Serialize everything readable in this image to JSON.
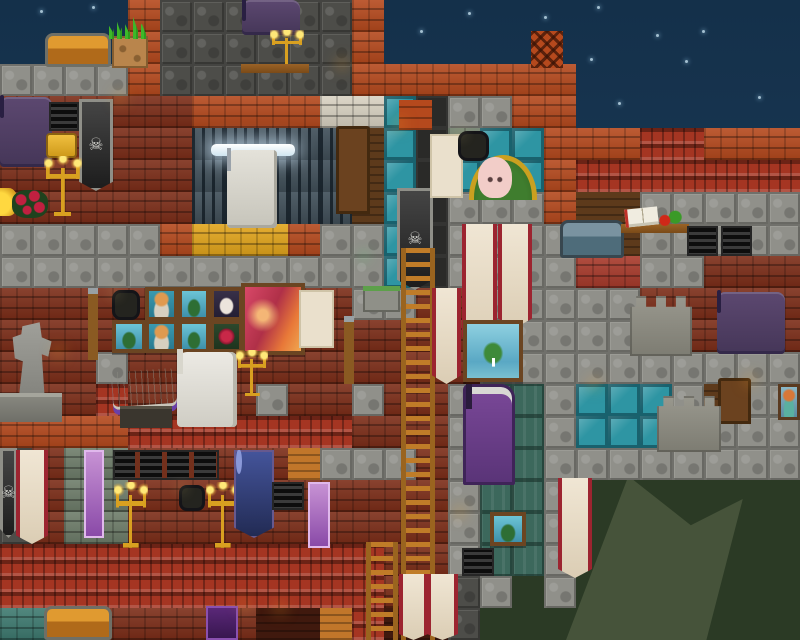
{
  "screen": {
    "width": 800,
    "height": 640
  },
  "palette": {
    "skyTop": "#14304a",
    "skyBottom": "#204260",
    "hills": "#2b3a25",
    "hillLight": "#46533a",
    "flame": "#ffb428",
    "gold": "#d8a020",
    "bannerRed": "#9c2430",
    "cream": "#f0e6d4",
    "teal": "#45e0d8",
    "purpleTv": "#5c4870"
  },
  "scene": {
    "tile_size": 32,
    "grid": [
      25,
      20
    ],
    "legend": {
      "B": {
        "name": "tile-brick-orange",
        "color": "#b5491d"
      },
      "b": {
        "name": "tile-brick-dark-red",
        "color": "#7c2d18"
      },
      "S": {
        "name": "tile-stone-block",
        "color": "#90908a"
      },
      "s": {
        "name": "tile-cobble-dark",
        "color": "#4d4d49"
      },
      "T": {
        "name": "tile-glass-teal",
        "color": "#2e95a3"
      },
      "R": {
        "name": "tile-roof-shingles",
        "color": "#a53522"
      },
      "G": {
        "name": "tile-gold-block",
        "color": "#e2a51c"
      },
      "W": {
        "name": "tile-brick-white",
        "color": "#d9d2c2"
      },
      "K": {
        "name": "tile-stone-green",
        "color": "#6e7d6a"
      },
      "w": {
        "name": "tile-wood-panel",
        "color": "#5d3a1b"
      },
      "O": {
        "name": "tile-wood-beam",
        "color": "#c1762a"
      },
      "D": {
        "name": "tile-dark-shaft",
        "color": "#2a2a28"
      },
      "J": {
        "name": "tile-window-bars",
        "color": "#46555f"
      },
      "t": {
        "name": "tile-brick-teal",
        "color": "#3e7a70"
      },
      "m": {
        "name": "tile-maroon-dark",
        "color": "#40190e"
      },
      "q": {
        "name": "tile-block-red",
        "color": "#a83a2b"
      },
      "P": {
        "name": "tile-panel-teal",
        "color": "#3c685c"
      }
    },
    "rows": [
      "....BssssssB.............",
      "....BssssssB.............",
      "SSSSBssssssBBBBBBB.......",
      "bbbbbbBBBBWWTDSSBB.......",
      "bbbbbbJJJJJwTDKTTBBBRRBBB",
      "bbbbbbJJJJJwTDTTTBRRRRRRR",
      "bbbbbbJJJJJwTDSSSBwwSSSSS",
      "SSSSSBGGGBSSTDSSSSwwSSSSS",
      "SSSSSSSSSSSSTDSSSSqqSSbbb",
      "bbbbbbbbbbbSSbbSSSSSbbbbb",
      "bbbbbbbbbbbbbbbSSSSSbbbbb",
      "bbbSbbbbbbbbbbbSSSSSSSSSS",
      "bbbRbbbbSbbSbbSPPSTTTSwSS",
      "BBBBRRRRRRRbbbSPPSTTTSSSS",
      "sbKKbbbbbOSSSbSPPSSSSSSSS",
      "sbKKbbbbbbbbbbSPPS.......",
      "sbKKbbbbbbbbbbSPPS.......",
      "RRRRRRRRRRRRbbSPPS.......",
      "RRRRRRRRRRRRbssS.S.......",
      "ttbbbbbbmmORmms.........."
    ],
    "backdrop": [
      {
        "t": "hill",
        "n": "hills-dark-west",
        "x": 455,
        "y": 540,
        "w": 345,
        "h": 100
      },
      {
        "t": "hill",
        "n": "hills-dark-east",
        "x": 533,
        "y": 476,
        "w": 267,
        "h": 164
      },
      {
        "t": "hill2",
        "n": "hillside-ridge",
        "x": 540,
        "y": 476,
        "w": 260,
        "h": 164
      }
    ],
    "stars": [
      [
        40,
        10
      ],
      [
        92,
        6
      ],
      [
        420,
        30
      ],
      [
        468,
        12
      ],
      [
        544,
        16
      ],
      [
        597,
        6
      ],
      [
        656,
        34
      ],
      [
        590,
        58
      ],
      [
        618,
        102
      ],
      [
        702,
        30
      ],
      [
        758,
        96
      ],
      [
        685,
        60
      ]
    ],
    "entities": [
      {
        "t": "block-orange",
        "n": "shaft-cap-block",
        "x": 399,
        "y": 100,
        "w": 33,
        "h": 30,
        "i": false
      },
      {
        "t": "lattice",
        "n": "chimney-lattice",
        "x": 531,
        "y": 31,
        "w": 32,
        "h": 37,
        "i": false
      },
      {
        "t": "door",
        "n": "wooden-door-upper",
        "x": 336,
        "y": 126,
        "w": 34,
        "h": 88,
        "i": true
      },
      {
        "t": "moss",
        "n": "mossy-ledge",
        "x": 363,
        "y": 286,
        "w": 37,
        "h": 26,
        "i": false
      },
      {
        "t": "tv",
        "n": "wall-tv-left",
        "x": 0,
        "y": 97,
        "w": 52,
        "h": 70,
        "i": true
      },
      {
        "t": "vent",
        "n": "air-vent-1",
        "x": 49,
        "y": 102,
        "w": 30,
        "h": 29,
        "i": false
      },
      {
        "t": "sign",
        "n": "gold-sign",
        "x": 46,
        "y": 133,
        "w": 31,
        "h": 25,
        "i": false
      },
      {
        "t": "banner-skull",
        "n": "skull-banner-left",
        "x": 79,
        "y": 99,
        "w": 34,
        "h": 92,
        "i": false
      },
      {
        "t": "torch",
        "n": "torch-upper-left",
        "x": 120,
        "y": 98,
        "w": 24,
        "h": 38,
        "i": false
      },
      {
        "t": "candelabra",
        "n": "wall-candelabra-left",
        "x": 44,
        "y": 156,
        "w": 38,
        "h": 60,
        "i": false
      },
      {
        "t": "goldpile",
        "n": "gold-treasure",
        "x": 0,
        "y": 188,
        "w": 18,
        "h": 28,
        "i": false
      },
      {
        "t": "roses",
        "n": "rose-bush",
        "x": 12,
        "y": 190,
        "w": 36,
        "h": 28,
        "i": false
      },
      {
        "t": "tv",
        "n": "wall-tv-dining",
        "x": 242,
        "y": 0,
        "w": 58,
        "h": 35,
        "i": true
      },
      {
        "t": "chair",
        "n": "dining-chair-left",
        "x": 203,
        "y": 46,
        "w": 30,
        "h": 52,
        "i": false
      },
      {
        "t": "chair",
        "n": "dining-chair-right",
        "x": 305,
        "y": 46,
        "w": 30,
        "h": 52,
        "i": false
      },
      {
        "t": "candelabra",
        "n": "table-candelabra",
        "x": 270,
        "y": 30,
        "w": 34,
        "h": 38,
        "i": false
      },
      {
        "t": "table",
        "n": "dining-table",
        "x": 241,
        "y": 64,
        "w": 68,
        "h": 34,
        "i": false
      },
      {
        "t": "torch",
        "n": "torch-dining",
        "x": 342,
        "y": 64,
        "w": 24,
        "h": 36,
        "i": false
      },
      {
        "t": "chest-wood",
        "n": "wooden-chest-top",
        "x": 45,
        "y": 33,
        "w": 66,
        "h": 34,
        "i": true
      },
      {
        "t": "dirt",
        "n": "dirt-block",
        "x": 112,
        "y": 36,
        "w": 36,
        "h": 32,
        "i": false
      },
      {
        "t": "grass",
        "n": "grass-tuft",
        "x": 109,
        "y": 17,
        "w": 40,
        "h": 22,
        "i": false
      },
      {
        "t": "fluoro",
        "n": "fluorescent-lamp",
        "x": 211,
        "y": 144,
        "w": 84,
        "h": 12,
        "i": false
      },
      {
        "t": "machine",
        "n": "crafting-station",
        "x": 227,
        "y": 150,
        "w": 50,
        "h": 78,
        "i": true
      },
      {
        "t": "stool",
        "n": "workshop-stool",
        "x": 275,
        "y": 194,
        "w": 28,
        "h": 32,
        "i": false
      },
      {
        "t": "char-engineer",
        "n": "npc-engineer",
        "x": 184,
        "y": 164,
        "w": 44,
        "h": 60,
        "i": true
      },
      {
        "t": "lantern",
        "n": "caged-lantern-1",
        "x": 112,
        "y": 290,
        "w": 28,
        "h": 30,
        "i": false
      },
      {
        "t": "p-portrait",
        "n": "painting-portrait-1",
        "x": 145,
        "y": 287,
        "w": 33,
        "h": 34,
        "i": false
      },
      {
        "t": "p-island",
        "n": "painting-island-1",
        "x": 178,
        "y": 287,
        "w": 32,
        "h": 34,
        "i": false
      },
      {
        "t": "p-bunny",
        "n": "painting-bunny",
        "x": 210,
        "y": 287,
        "w": 33,
        "h": 34,
        "i": false
      },
      {
        "t": "p-island",
        "n": "painting-island-2",
        "x": 112,
        "y": 320,
        "w": 34,
        "h": 33,
        "i": false
      },
      {
        "t": "p-portrait",
        "n": "painting-portrait-2",
        "x": 145,
        "y": 320,
        "w": 33,
        "h": 33,
        "i": false
      },
      {
        "t": "p-island",
        "n": "painting-island-3",
        "x": 178,
        "y": 320,
        "w": 32,
        "h": 33,
        "i": false
      },
      {
        "t": "p-rose",
        "n": "painting-rose",
        "x": 210,
        "y": 320,
        "w": 33,
        "h": 33,
        "i": false
      },
      {
        "t": "p-sunset",
        "n": "painting-sunset-large",
        "x": 241,
        "y": 283,
        "w": 64,
        "h": 72,
        "i": false
      },
      {
        "t": "poster",
        "n": "cat-poster-1",
        "x": 299,
        "y": 290,
        "w": 35,
        "h": 58,
        "i": false
      },
      {
        "t": "pole",
        "n": "hook-pole-1",
        "x": 88,
        "y": 288,
        "w": 10,
        "h": 72,
        "i": false
      },
      {
        "t": "pole",
        "n": "hook-pole-2",
        "x": 344,
        "y": 316,
        "w": 10,
        "h": 68,
        "i": false
      },
      {
        "t": "statue",
        "n": "stone-statue",
        "x": 4,
        "y": 315,
        "w": 54,
        "h": 80,
        "i": false
      },
      {
        "t": "pedestal",
        "n": "statue-pedestal",
        "x": 0,
        "y": 393,
        "w": 62,
        "h": 29,
        "i": false
      },
      {
        "t": "torch",
        "n": "torch-statue",
        "x": 58,
        "y": 352,
        "w": 22,
        "h": 34,
        "i": false
      },
      {
        "t": "printer",
        "n": "book-machine",
        "x": 112,
        "y": 370,
        "w": 64,
        "h": 38,
        "i": true
      },
      {
        "t": "stand",
        "n": "machine-stand",
        "x": 120,
        "y": 406,
        "w": 52,
        "h": 22,
        "i": false
      },
      {
        "t": "console",
        "n": "navigation-console",
        "x": 177,
        "y": 352,
        "w": 60,
        "h": 75,
        "i": true
      },
      {
        "t": "candelabra",
        "n": "wall-candelabra-mid",
        "x": 236,
        "y": 350,
        "w": 32,
        "h": 46,
        "i": false
      },
      {
        "t": "mushroom",
        "n": "glow-mushroom",
        "x": 364,
        "y": 256,
        "w": 32,
        "h": 36,
        "i": false
      },
      {
        "t": "banner-skull",
        "n": "skull-banner-shaft",
        "x": 397,
        "y": 188,
        "w": 36,
        "h": 102,
        "i": false
      },
      {
        "t": "torch",
        "n": "torch-shaft",
        "x": 399,
        "y": 124,
        "w": 24,
        "h": 38,
        "i": false
      },
      {
        "t": "poster",
        "n": "cat-poster-2",
        "x": 430,
        "y": 134,
        "w": 33,
        "h": 64,
        "i": false
      },
      {
        "t": "lantern",
        "n": "caged-lantern-2",
        "x": 458,
        "y": 131,
        "w": 31,
        "h": 30,
        "i": false
      },
      {
        "t": "pet-house",
        "n": "pet-house",
        "x": 469,
        "y": 155,
        "w": 68,
        "h": 45,
        "i": false
      },
      {
        "t": "bunny",
        "n": "pet-bunny",
        "x": 478,
        "y": 157,
        "w": 34,
        "h": 41,
        "i": true
      },
      {
        "t": "ladder",
        "n": "ladder-main",
        "x": 401,
        "y": 248,
        "w": 34,
        "h": 392,
        "i": true
      },
      {
        "t": "char-astronaut",
        "n": "player-astronaut",
        "x": 403,
        "y": 326,
        "w": 34,
        "h": 64,
        "i": true
      },
      {
        "t": "banner-red",
        "n": "rune-banner-1",
        "x": 432,
        "y": 288,
        "w": 29,
        "h": 96,
        "i": false
      },
      {
        "t": "banner-red",
        "n": "rune-banner-2",
        "x": 462,
        "y": 224,
        "w": 35,
        "h": 124,
        "i": false
      },
      {
        "t": "banner-red",
        "n": "rune-banner-3",
        "x": 498,
        "y": 224,
        "w": 34,
        "h": 104,
        "i": false
      },
      {
        "t": "p-floating",
        "n": "painting-floating-island",
        "x": 463,
        "y": 320,
        "w": 60,
        "h": 62,
        "i": false
      },
      {
        "t": "arcade",
        "n": "arcade-cabinet",
        "x": 463,
        "y": 384,
        "w": 52,
        "h": 101,
        "i": true
      },
      {
        "t": "chest-fancy",
        "n": "fancy-chest",
        "x": 560,
        "y": 220,
        "w": 64,
        "h": 38,
        "i": true
      },
      {
        "t": "table",
        "n": "study-table",
        "x": 621,
        "y": 224,
        "w": 68,
        "h": 32,
        "i": false
      },
      {
        "t": "book",
        "n": "open-book",
        "x": 625,
        "y": 208,
        "w": 33,
        "h": 18,
        "i": false
      },
      {
        "t": "fruit",
        "n": "fruit-and-plant",
        "x": 657,
        "y": 210,
        "w": 26,
        "h": 16,
        "i": false
      },
      {
        "t": "vent",
        "n": "air-vent-2",
        "x": 687,
        "y": 226,
        "w": 31,
        "h": 30,
        "i": false
      },
      {
        "t": "vent",
        "n": "air-vent-3",
        "x": 721,
        "y": 226,
        "w": 31,
        "h": 30,
        "i": false
      },
      {
        "t": "tv",
        "n": "wall-tv-big",
        "x": 717,
        "y": 292,
        "w": 68,
        "h": 62,
        "i": true
      },
      {
        "t": "tower",
        "n": "stone-tower-upper",
        "x": 630,
        "y": 296,
        "w": 62,
        "h": 60,
        "i": false
      },
      {
        "t": "torch",
        "n": "torch-glass-wall",
        "x": 594,
        "y": 384,
        "w": 24,
        "h": 38,
        "i": false
      },
      {
        "t": "door",
        "n": "wooden-door-right",
        "x": 718,
        "y": 378,
        "w": 33,
        "h": 46,
        "i": true
      },
      {
        "t": "tower",
        "n": "stone-tower-lower",
        "x": 657,
        "y": 396,
        "w": 64,
        "h": 56,
        "i": false
      },
      {
        "t": "torch",
        "n": "torch-right-wall",
        "x": 750,
        "y": 380,
        "w": 26,
        "h": 40,
        "i": false
      },
      {
        "t": "portrait-mini",
        "n": "portrait-painting-right",
        "x": 778,
        "y": 384,
        "w": 22,
        "h": 36,
        "i": false
      },
      {
        "t": "sawhorse",
        "n": "sawhorse-table-right",
        "x": 592,
        "y": 416,
        "w": 62,
        "h": 34,
        "i": true
      },
      {
        "t": "banner-skull",
        "n": "skull-banner-bottom",
        "x": 0,
        "y": 448,
        "w": 17,
        "h": 90,
        "i": false
      },
      {
        "t": "banner-red",
        "n": "rune-banner-4",
        "x": 16,
        "y": 450,
        "w": 32,
        "h": 94,
        "i": false
      },
      {
        "t": "banner-tech",
        "n": "tech-banner-1",
        "x": 84,
        "y": 450,
        "w": 20,
        "h": 88,
        "i": false
      },
      {
        "t": "vents-strip",
        "n": "vent-row",
        "x": 113,
        "y": 450,
        "w": 106,
        "h": 30,
        "i": false
      },
      {
        "t": "candelabra",
        "n": "floor-candelabra-1",
        "x": 114,
        "y": 482,
        "w": 34,
        "h": 66,
        "i": false
      },
      {
        "t": "lantern",
        "n": "caged-lantern-3",
        "x": 179,
        "y": 485,
        "w": 26,
        "h": 26,
        "i": false
      },
      {
        "t": "candelabra",
        "n": "floor-candelabra-2",
        "x": 206,
        "y": 482,
        "w": 34,
        "h": 66,
        "i": false
      },
      {
        "t": "sawhorse",
        "n": "sawhorse-table-left",
        "x": 141,
        "y": 512,
        "w": 68,
        "h": 36,
        "i": true
      },
      {
        "t": "banner-blue",
        "n": "eye-banner",
        "x": 234,
        "y": 450,
        "w": 40,
        "h": 88,
        "i": false
      },
      {
        "t": "vent",
        "n": "air-vent-4",
        "x": 272,
        "y": 482,
        "w": 32,
        "h": 28,
        "i": false
      },
      {
        "t": "banner-tech",
        "n": "tech-banner-2",
        "x": 308,
        "y": 482,
        "w": 22,
        "h": 66,
        "i": false
      },
      {
        "t": "ladder",
        "n": "ladder-short",
        "x": 366,
        "y": 542,
        "w": 32,
        "h": 98,
        "i": true
      },
      {
        "t": "torch",
        "n": "torch-panel",
        "x": 460,
        "y": 512,
        "w": 27,
        "h": 34,
        "i": false
      },
      {
        "t": "p-island",
        "n": "painting-island-small",
        "x": 490,
        "y": 512,
        "w": 36,
        "h": 34,
        "i": false
      },
      {
        "t": "vent",
        "n": "air-vent-5",
        "x": 462,
        "y": 548,
        "w": 32,
        "h": 28,
        "i": false
      },
      {
        "t": "banner-red",
        "n": "rune-banner-5",
        "x": 558,
        "y": 478,
        "w": 34,
        "h": 100,
        "i": false
      },
      {
        "t": "banner-red",
        "n": "rune-banner-6",
        "x": 399,
        "y": 574,
        "w": 29,
        "h": 66,
        "i": false
      },
      {
        "t": "banner-red",
        "n": "rune-banner-7",
        "x": 427,
        "y": 574,
        "w": 31,
        "h": 66,
        "i": false
      },
      {
        "t": "chest-wood",
        "n": "wooden-chest-bottom",
        "x": 44,
        "y": 606,
        "w": 68,
        "h": 34,
        "i": true
      },
      {
        "t": "banner-purple",
        "n": "purple-banner-small",
        "x": 206,
        "y": 606,
        "w": 32,
        "h": 34,
        "i": false
      },
      {
        "t": "torch",
        "n": "torch-bottom-1",
        "x": 244,
        "y": 604,
        "w": 20,
        "h": 34,
        "i": false
      },
      {
        "t": "torch",
        "n": "torch-bottom-2",
        "x": 280,
        "y": 608,
        "w": 20,
        "h": 32,
        "i": false
      }
    ]
  }
}
